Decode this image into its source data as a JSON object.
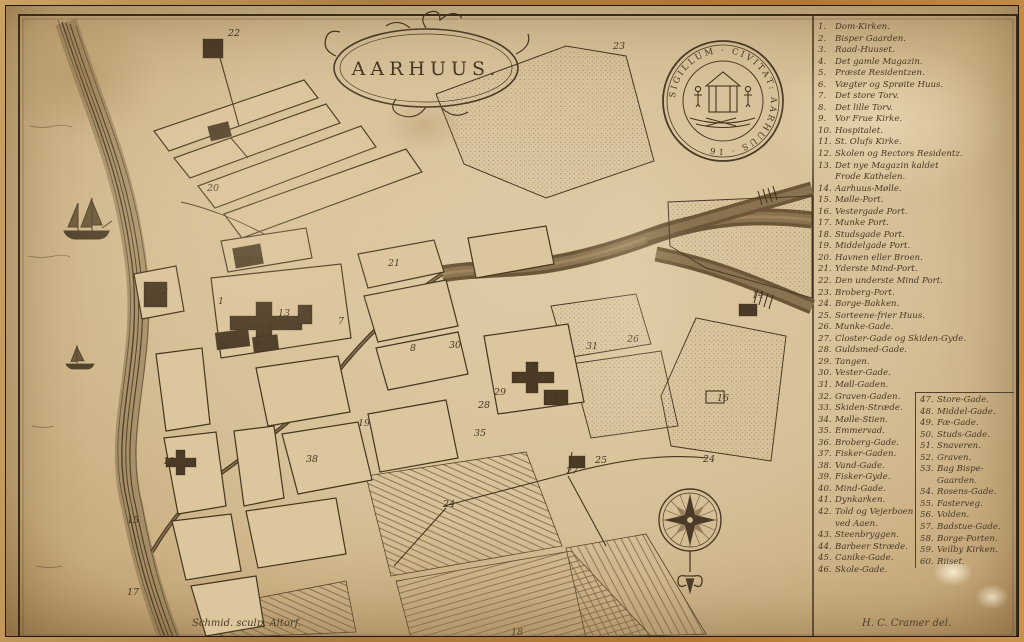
{
  "title": "AARHUUS.",
  "seal_text": "SIGILLUM · CIVITAT: AARHUUS · 16",
  "signatures": {
    "left": "Schmid. sculp. Altorf.",
    "right": "H. C. Cramer del."
  },
  "colors": {
    "paper": "#d6c097",
    "ink": "#44351f",
    "dark_building": "#4a3a26"
  },
  "legend": {
    "column_break": 46,
    "items": [
      {
        "num": "1.",
        "label": "Dom-Kirken."
      },
      {
        "num": "2.",
        "label": "Bisper Gaarden."
      },
      {
        "num": "3.",
        "label": "Raad-Huuset."
      },
      {
        "num": "4.",
        "label": "Det gamle Magazin."
      },
      {
        "num": "5.",
        "label": "Præste Residentzen."
      },
      {
        "num": "6.",
        "label": "Vægter og Sprøite Huus."
      },
      {
        "num": "7.",
        "label": "Det store Torv."
      },
      {
        "num": "8.",
        "label": "Det lille Torv."
      },
      {
        "num": "9.",
        "label": "Vor Frue Kirke."
      },
      {
        "num": "10.",
        "label": "Hospitalet."
      },
      {
        "num": "11.",
        "label": "St. Olufs Kirke."
      },
      {
        "num": "12.",
        "label": "Skolen og Rectors Residentz."
      },
      {
        "num": "13.",
        "label": "Det nye Magazin kaldet\nFrode Kathelen."
      },
      {
        "num": "14.",
        "label": "Aarhuus-Mølle."
      },
      {
        "num": "15.",
        "label": "Mølle-Port."
      },
      {
        "num": "16.",
        "label": "Vestergade Port."
      },
      {
        "num": "17.",
        "label": "Munke Port."
      },
      {
        "num": "18.",
        "label": "Studsgade Port."
      },
      {
        "num": "19.",
        "label": "Middelgade Port."
      },
      {
        "num": "20.",
        "label": "Havnen eller Broen."
      },
      {
        "num": "21.",
        "label": "Yderste Mind-Port."
      },
      {
        "num": "22.",
        "label": "Den underste Mind Port."
      },
      {
        "num": "23.",
        "label": "Broberg-Port."
      },
      {
        "num": "24.",
        "label": "Borge-Bakken."
      },
      {
        "num": "25.",
        "label": "Sorteene-frier Huus."
      },
      {
        "num": "26.",
        "label": "Munke-Gade."
      },
      {
        "num": "27.",
        "label": "Closter-Gade og Skiden-Gyde."
      },
      {
        "num": "28.",
        "label": "Guldsmed-Gade."
      },
      {
        "num": "29.",
        "label": "Tangen."
      },
      {
        "num": "30.",
        "label": "Vester-Gade."
      },
      {
        "num": "31.",
        "label": "Møll-Gaden."
      },
      {
        "num": "32.",
        "label": "Graven-Gaden."
      },
      {
        "num": "33.",
        "label": "Skiden-Stræde."
      },
      {
        "num": "34.",
        "label": "Mølle-Stien."
      },
      {
        "num": "35.",
        "label": "Emmervad."
      },
      {
        "num": "36.",
        "label": "Broberg-Gade."
      },
      {
        "num": "37.",
        "label": "Fisker-Gaden."
      },
      {
        "num": "38.",
        "label": "Vand-Gade."
      },
      {
        "num": "39.",
        "label": "Fisker-Gyde."
      },
      {
        "num": "40.",
        "label": "Mind-Gade."
      },
      {
        "num": "41.",
        "label": "Dynkarken."
      },
      {
        "num": "42.",
        "label": "Told og Vejerboen\nved Aaen."
      },
      {
        "num": "43.",
        "label": "Steenbryggen."
      },
      {
        "num": "44.",
        "label": "Barbeer Stræde."
      },
      {
        "num": "45.",
        "label": "Canike-Gade."
      },
      {
        "num": "46.",
        "label": "Skole-Gade."
      },
      {
        "num": "47.",
        "label": "Store-Gade."
      },
      {
        "num": "48.",
        "label": "Middel-Gade."
      },
      {
        "num": "49.",
        "label": "Fæ-Gade."
      },
      {
        "num": "50.",
        "label": "Studs-Gade."
      },
      {
        "num": "51.",
        "label": "Snaveren."
      },
      {
        "num": "52.",
        "label": "Graven."
      },
      {
        "num": "53.",
        "label": "Bag Bispe-\nGaarden."
      },
      {
        "num": "54.",
        "label": "Rosens-Gade."
      },
      {
        "num": "55.",
        "label": "Fasterveg."
      },
      {
        "num": "56.",
        "label": "Volden."
      },
      {
        "num": "57.",
        "label": "Badstue-Gade."
      },
      {
        "num": "58.",
        "label": "Borge-Porten."
      },
      {
        "num": "59.",
        "label": "Veilby Kirken."
      },
      {
        "num": "60.",
        "label": "Riiset."
      }
    ]
  },
  "map_labels": [
    {
      "t": "22",
      "x": 222,
      "y": 30
    },
    {
      "t": "23",
      "x": 607,
      "y": 43
    },
    {
      "t": "20",
      "x": 201,
      "y": 185
    },
    {
      "t": "2",
      "x": 240,
      "y": 258
    },
    {
      "t": "12",
      "x": 150,
      "y": 288
    },
    {
      "t": "1",
      "x": 212,
      "y": 298
    },
    {
      "t": "13",
      "x": 272,
      "y": 310
    },
    {
      "t": "3",
      "x": 300,
      "y": 306
    },
    {
      "t": "6",
      "x": 261,
      "y": 323
    },
    {
      "t": "5",
      "x": 226,
      "y": 334
    },
    {
      "t": "4",
      "x": 248,
      "y": 339
    },
    {
      "t": "7",
      "x": 332,
      "y": 318
    },
    {
      "t": "21",
      "x": 382,
      "y": 260
    },
    {
      "t": "8",
      "x": 404,
      "y": 345
    },
    {
      "t": "30",
      "x": 443,
      "y": 342
    },
    {
      "t": "29",
      "x": 488,
      "y": 389
    },
    {
      "t": "28",
      "x": 472,
      "y": 402
    },
    {
      "t": "9",
      "x": 524,
      "y": 364
    },
    {
      "t": "10",
      "x": 548,
      "y": 393
    },
    {
      "t": "31",
      "x": 580,
      "y": 343
    },
    {
      "t": "26",
      "x": 621,
      "y": 336
    },
    {
      "t": "14",
      "x": 746,
      "y": 292
    },
    {
      "t": "16",
      "x": 711,
      "y": 395
    },
    {
      "t": "24",
      "x": 437,
      "y": 501
    },
    {
      "t": "24",
      "x": 697,
      "y": 456
    },
    {
      "t": "25",
      "x": 589,
      "y": 457
    },
    {
      "t": "27",
      "x": 560,
      "y": 468
    },
    {
      "t": "19",
      "x": 352,
      "y": 420
    },
    {
      "t": "35",
      "x": 468,
      "y": 430
    },
    {
      "t": "38",
      "x": 300,
      "y": 456
    },
    {
      "t": "11",
      "x": 157,
      "y": 458
    },
    {
      "t": "15",
      "x": 121,
      "y": 517
    },
    {
      "t": "17",
      "x": 121,
      "y": 589
    },
    {
      "t": "18",
      "x": 505,
      "y": 629
    }
  ]
}
